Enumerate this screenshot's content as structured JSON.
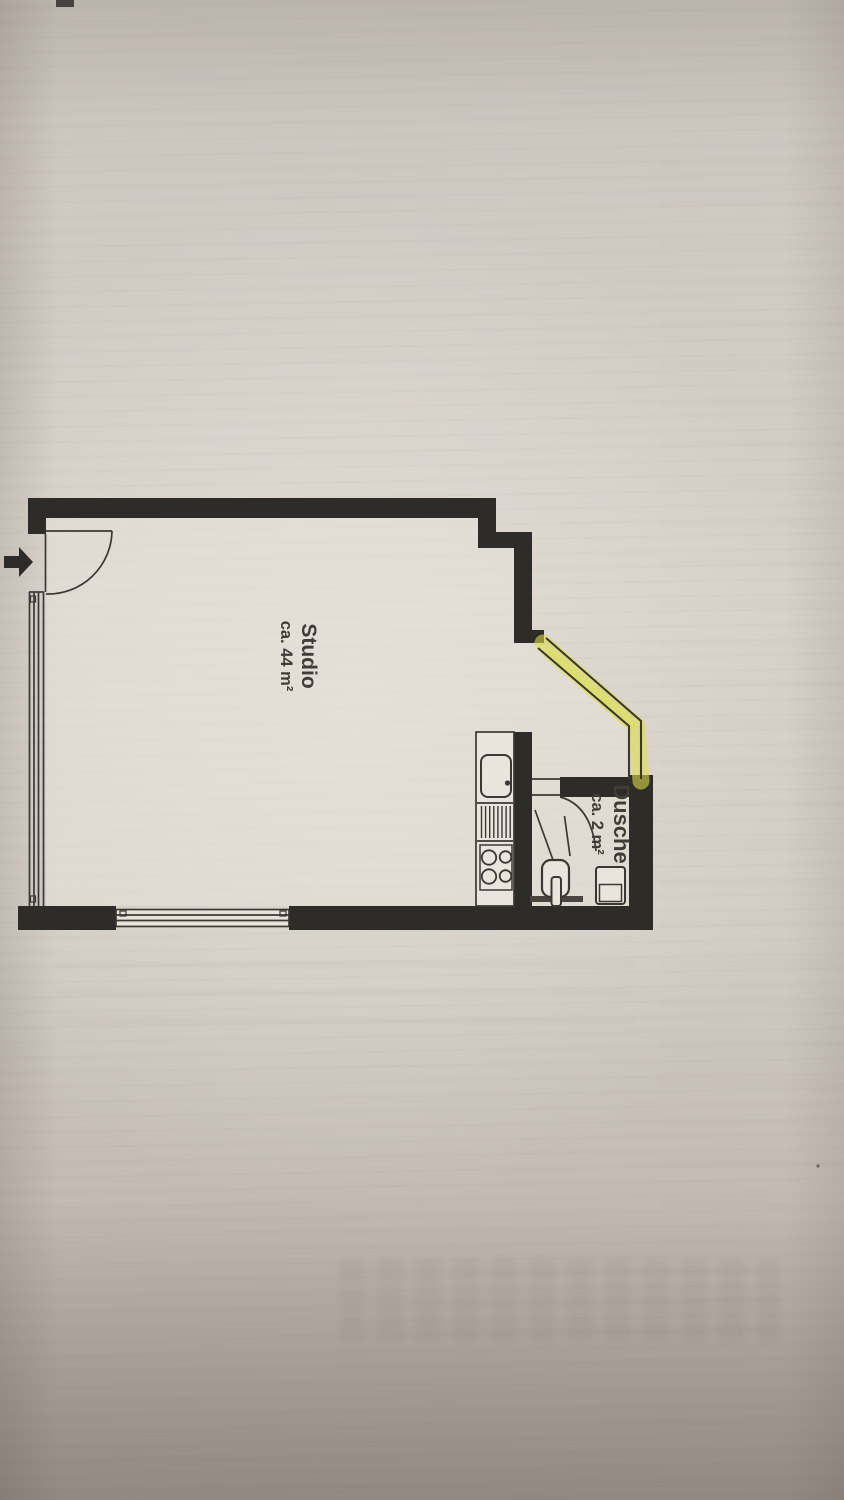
{
  "floor_plan": {
    "rooms": [
      {
        "id": "studio",
        "label": "Studio",
        "area_label": "ca. 44 m²"
      },
      {
        "id": "shower_room",
        "label": "Dusche",
        "area_label": "ca. 2 m²"
      }
    ],
    "wall_color": "#2e2c29",
    "line_color": "#3b3833",
    "highlight_color": "#dfe04a",
    "paper_color": "#d5cfc7",
    "room_fill_color": "#e7e2d9",
    "fixtures": [
      "entrance-arrow",
      "entrance-door-swing",
      "window-left",
      "window-bottom",
      "window-diagonal-highlighted",
      "kitchen-sink",
      "kitchen-drainboard",
      "cooktop-4-burner",
      "shower-door-swing",
      "shower-marks",
      "toilet",
      "washbasin"
    ]
  }
}
